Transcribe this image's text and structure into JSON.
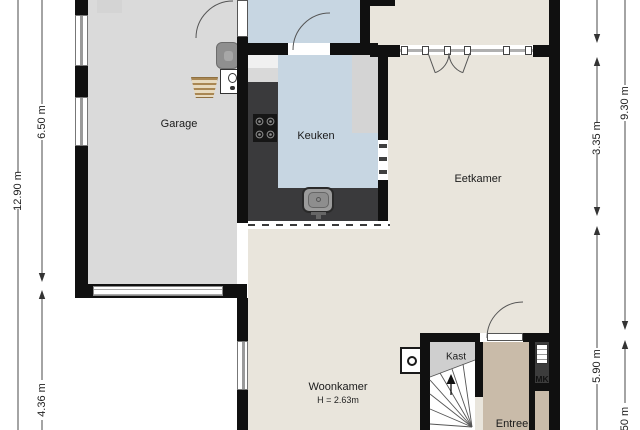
{
  "floorplan": {
    "rooms": {
      "garage": {
        "label": "Garage"
      },
      "keuken": {
        "label": "Keuken"
      },
      "eetkamer": {
        "label": "Eetkamer"
      },
      "woonkamer": {
        "label": "Woonkamer",
        "height_note": "H = 2.63m"
      },
      "kast": {
        "label": "Kast"
      },
      "entree": {
        "label": "Entree"
      },
      "meterkast": {
        "label": "MK"
      }
    },
    "dimensions": {
      "left_total": "12.90 m",
      "left_upper": "6.50 m",
      "left_lower": "4.36 m",
      "right_total": "9.30 m",
      "right_upper": "3.35 m",
      "right_lower": "5.90 m",
      "right_bottom_partial": "50 m"
    },
    "icons": [
      "gas-hob-icon",
      "kitchen-sink-icon",
      "washing-machine-icon",
      "boiler-icon",
      "drying-rack-icon",
      "stairs-up-arrow-icon",
      "fireplace-stove-icon",
      "meter-cabinet-icon",
      "door-swing-icon",
      "window-icon",
      "garage-door-icon"
    ],
    "colors": {
      "wall": "#101010",
      "garage_floor": "#dadada",
      "kitchen_floor": "#c7d6e2",
      "living_floor": "#e9e5dc",
      "entree_floor": "#c9bba9",
      "kast_floor": "#cfcfcf",
      "counter": "#3a3a3c"
    }
  }
}
